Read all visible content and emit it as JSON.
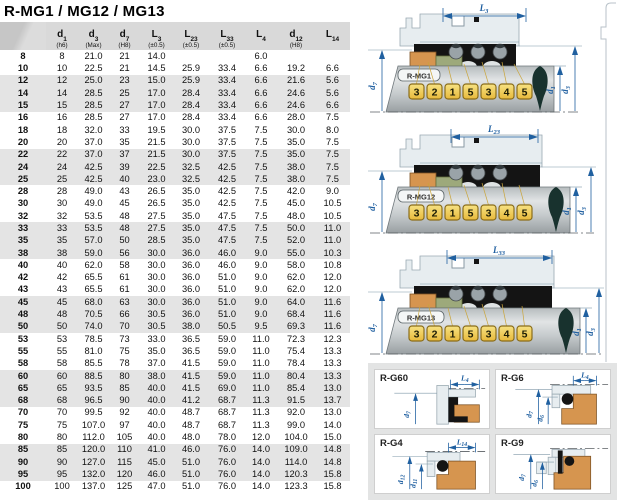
{
  "title": "R-MG1 / MG12 / MG13",
  "colors": {
    "dimension_blue": "#1f5fa0",
    "seat_orange": "#d6954f",
    "carbon_olive": "#9da97b",
    "marker_yellow": "#f2c94c",
    "header_gray": "#d9d9d9",
    "band_gray": "#e4e4e4"
  },
  "table": {
    "columns": [
      {
        "main": "",
        "sub": "",
        "note": ""
      },
      {
        "main": "d",
        "sub": "1",
        "note": "(h6)"
      },
      {
        "main": "d",
        "sub": "3",
        "note": "(Max)"
      },
      {
        "main": "d",
        "sub": "7",
        "note": "(H8)"
      },
      {
        "main": "L",
        "sub": "3",
        "note": "(±0.5)"
      },
      {
        "main": "L",
        "sub": "23",
        "note": "(±0.5)"
      },
      {
        "main": "L",
        "sub": "33",
        "note": "(±0.5)"
      },
      {
        "main": "L",
        "sub": "4",
        "note": ""
      },
      {
        "main": "d",
        "sub": "12",
        "note": "(H8)"
      },
      {
        "main": "L",
        "sub": "14",
        "note": ""
      }
    ],
    "rows": [
      [
        "8",
        "8",
        "21.0",
        "21",
        "14.0",
        "",
        "",
        "6.0",
        "",
        ""
      ],
      [
        "10",
        "10",
        "22.5",
        "21",
        "14.5",
        "25.9",
        "33.4",
        "6.6",
        "19.2",
        "6.6"
      ],
      [
        "12",
        "12",
        "25.0",
        "23",
        "15.0",
        "25.9",
        "33.4",
        "6.6",
        "21.6",
        "5.6"
      ],
      [
        "14",
        "14",
        "28.5",
        "25",
        "17.0",
        "28.4",
        "33.4",
        "6.6",
        "24.6",
        "5.6"
      ],
      [
        "15",
        "15",
        "28.5",
        "27",
        "17.0",
        "28.4",
        "33.4",
        "6.6",
        "24.6",
        "6.6"
      ],
      [
        "16",
        "16",
        "28.5",
        "27",
        "17.0",
        "28.4",
        "33.4",
        "6.6",
        "28.0",
        "7.5"
      ],
      [
        "18",
        "18",
        "32.0",
        "33",
        "19.5",
        "30.0",
        "37.5",
        "7.5",
        "30.0",
        "8.0"
      ],
      [
        "20",
        "20",
        "37.0",
        "35",
        "21.5",
        "30.0",
        "37.5",
        "7.5",
        "35.0",
        "7.5"
      ],
      [
        "22",
        "22",
        "37.0",
        "37",
        "21.5",
        "30.0",
        "37.5",
        "7.5",
        "35.0",
        "7.5"
      ],
      [
        "24",
        "24",
        "42.5",
        "39",
        "22.5",
        "32.5",
        "42.5",
        "7.5",
        "38.0",
        "7.5"
      ],
      [
        "25",
        "25",
        "42.5",
        "40",
        "23.0",
        "32.5",
        "42.5",
        "7.5",
        "38.0",
        "7.5"
      ],
      [
        "28",
        "28",
        "49.0",
        "43",
        "26.5",
        "35.0",
        "42.5",
        "7.5",
        "42.0",
        "9.0"
      ],
      [
        "30",
        "30",
        "49.0",
        "45",
        "26.5",
        "35.0",
        "42.5",
        "7.5",
        "45.0",
        "10.5"
      ],
      [
        "32",
        "32",
        "53.5",
        "48",
        "27.5",
        "35.0",
        "47.5",
        "7.5",
        "48.0",
        "10.5"
      ],
      [
        "33",
        "33",
        "53.5",
        "48",
        "27.5",
        "35.0",
        "47.5",
        "7.5",
        "50.0",
        "11.0"
      ],
      [
        "35",
        "35",
        "57.0",
        "50",
        "28.5",
        "35.0",
        "47.5",
        "7.5",
        "52.0",
        "11.0"
      ],
      [
        "38",
        "38",
        "59.0",
        "56",
        "30.0",
        "36.0",
        "46.0",
        "9.0",
        "55.0",
        "10.3"
      ],
      [
        "40",
        "40",
        "62.0",
        "58",
        "30.0",
        "36.0",
        "46.0",
        "9.0",
        "58.0",
        "10.8"
      ],
      [
        "42",
        "42",
        "65.5",
        "61",
        "30.0",
        "36.0",
        "51.0",
        "9.0",
        "62.0",
        "12.0"
      ],
      [
        "43",
        "43",
        "65.5",
        "61",
        "30.0",
        "36.0",
        "51.0",
        "9.0",
        "62.0",
        "12.0"
      ],
      [
        "45",
        "45",
        "68.0",
        "63",
        "30.0",
        "36.0",
        "51.0",
        "9.0",
        "64.0",
        "11.6"
      ],
      [
        "48",
        "48",
        "70.5",
        "66",
        "30.5",
        "36.0",
        "51.0",
        "9.0",
        "68.4",
        "11.6"
      ],
      [
        "50",
        "50",
        "74.0",
        "70",
        "30.5",
        "38.0",
        "50.5",
        "9.5",
        "69.3",
        "11.6"
      ],
      [
        "53",
        "53",
        "78.5",
        "73",
        "33.0",
        "36.5",
        "59.0",
        "11.0",
        "72.3",
        "12.3"
      ],
      [
        "55",
        "55",
        "81.0",
        "75",
        "35.0",
        "36.5",
        "59.0",
        "11.0",
        "75.4",
        "13.3"
      ],
      [
        "58",
        "58",
        "85.5",
        "78",
        "37.0",
        "41.5",
        "59.0",
        "11.0",
        "78.4",
        "13.3"
      ],
      [
        "60",
        "60",
        "88.5",
        "80",
        "38.0",
        "41.5",
        "59.0",
        "11.0",
        "80.4",
        "13.3"
      ],
      [
        "65",
        "65",
        "93.5",
        "85",
        "40.0",
        "41.5",
        "69.0",
        "11.0",
        "85.4",
        "13.0"
      ],
      [
        "68",
        "68",
        "96.5",
        "90",
        "40.0",
        "41.2",
        "68.7",
        "11.3",
        "91.5",
        "13.7"
      ],
      [
        "70",
        "70",
        "99.5",
        "92",
        "40.0",
        "48.7",
        "68.7",
        "11.3",
        "92.0",
        "13.0"
      ],
      [
        "75",
        "75",
        "107.0",
        "97",
        "40.0",
        "48.7",
        "68.7",
        "11.3",
        "99.0",
        "14.0"
      ],
      [
        "80",
        "80",
        "112.0",
        "105",
        "40.0",
        "48.0",
        "78.0",
        "12.0",
        "104.0",
        "15.0"
      ],
      [
        "85",
        "85",
        "120.0",
        "110",
        "41.0",
        "46.0",
        "76.0",
        "14.0",
        "109.0",
        "14.8"
      ],
      [
        "90",
        "90",
        "127.0",
        "115",
        "45.0",
        "51.0",
        "76.0",
        "14.0",
        "114.0",
        "14.8"
      ],
      [
        "95",
        "95",
        "132.0",
        "120",
        "46.0",
        "51.0",
        "76.0",
        "14.0",
        "120.3",
        "15.8"
      ],
      [
        "100",
        "100",
        "137.0",
        "125",
        "47.0",
        "51.0",
        "76.0",
        "14.0",
        "123.3",
        "15.8"
      ]
    ]
  },
  "diagrams": [
    {
      "model": "R-MG1",
      "dim": "L",
      "dim_sub": "3",
      "d_left": "d",
      "d_left_sub": "7",
      "d_r1": "d",
      "d_r1_sub": "1",
      "d_r2": "d",
      "d_r2_sub": "3",
      "numbers": [
        "3",
        "2",
        "1",
        "5",
        "3",
        "4",
        "5"
      ]
    },
    {
      "model": "R-MG12",
      "dim": "L",
      "dim_sub": "23",
      "d_left": "d",
      "d_left_sub": "7",
      "d_r1": "d",
      "d_r1_sub": "1",
      "d_r2": "d",
      "d_r2_sub": "3",
      "numbers": [
        "3",
        "2",
        "1",
        "5",
        "3",
        "4",
        "5"
      ]
    },
    {
      "model": "R-MG13",
      "dim": "L",
      "dim_sub": "33",
      "d_left": "d",
      "d_left_sub": "7",
      "d_r1": "d",
      "d_r1_sub": "1",
      "d_r2": "d",
      "d_r2_sub": "3",
      "numbers": [
        "3",
        "2",
        "1",
        "5",
        "3",
        "4",
        "5"
      ]
    }
  ],
  "cards": [
    {
      "label": "R-G60",
      "dim": "L",
      "dim_sub": "4",
      "v1": "d",
      "v1_sub": "7",
      "v2": "",
      "v2_sub": ""
    },
    {
      "label": "R-G6",
      "dim": "L",
      "dim_sub": "4",
      "v1": "d",
      "v1_sub": "7",
      "v2": "d",
      "v2_sub": "6"
    },
    {
      "label": "R-G4",
      "dim": "L",
      "dim_sub": "14",
      "v1": "d",
      "v1_sub": "12",
      "v2": "d",
      "v2_sub": "11"
    },
    {
      "label": "R-G9",
      "dim": "",
      "dim_sub": "",
      "v1": "d",
      "v1_sub": "7",
      "v2": "d",
      "v2_sub": "6"
    }
  ]
}
